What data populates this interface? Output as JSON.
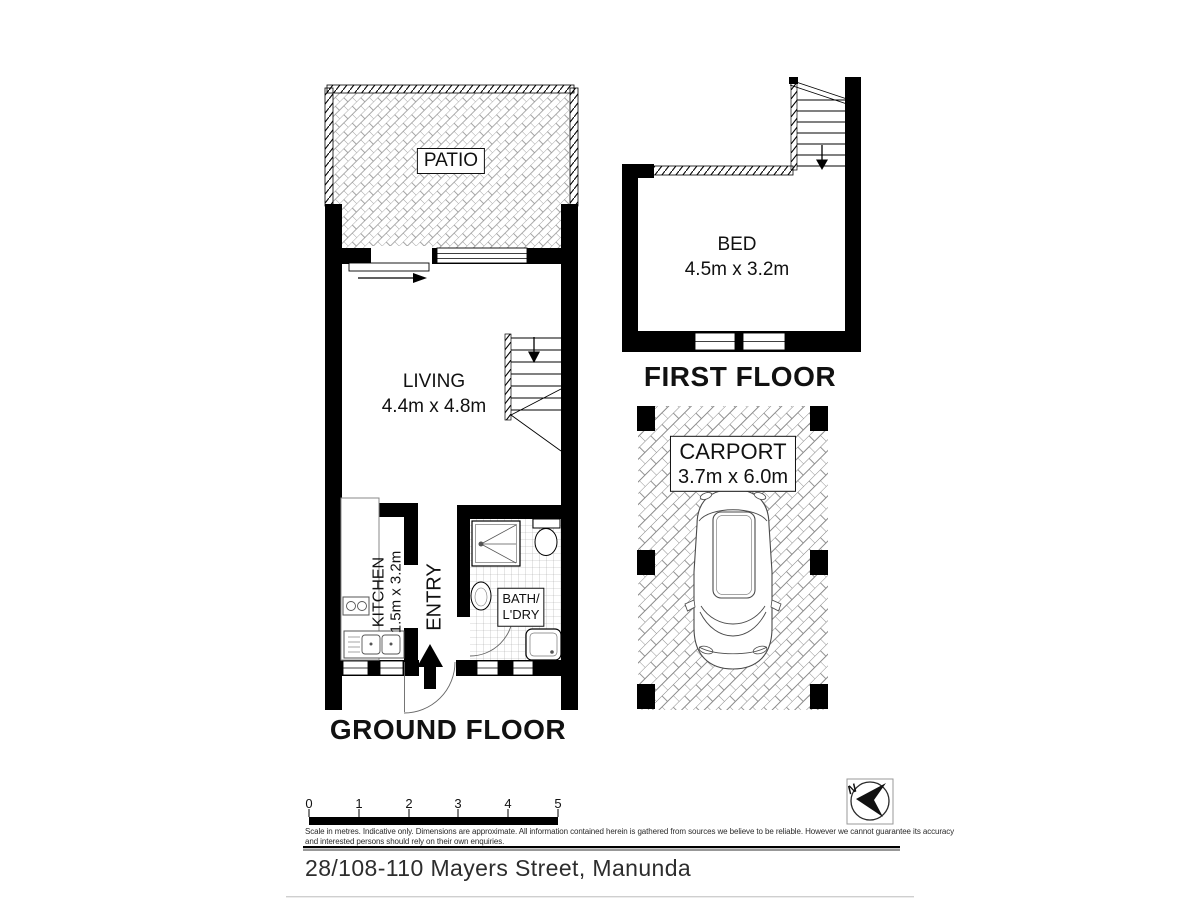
{
  "ground_floor": {
    "title": "GROUND FLOOR",
    "patio_label": "PATIO",
    "living_name": "LIVING",
    "living_dims": "4.4m x 4.8m",
    "kitchen_name": "KITCHEN",
    "kitchen_dims": "1.5m x 3.2m",
    "entry_label": "ENTRY",
    "bath_line1": "BATH/",
    "bath_line2": "L'DRY"
  },
  "first_floor": {
    "title": "FIRST FLOOR",
    "bed_name": "BED",
    "bed_dims": "4.5m x 3.2m"
  },
  "carport": {
    "name": "CARPORT",
    "dims": "3.7m x 6.0m"
  },
  "scale_bar": {
    "ticks": [
      "0",
      "1",
      "2",
      "3",
      "4",
      "5"
    ],
    "disclaimer_line1": "Scale in metres. Indicative only. Dimensions are approximate. All information contained herein is gathered from sources we believe to be reliable. However we cannot guarantee its accuracy",
    "disclaimer_line2": "and interested persons should rely on their own enquiries."
  },
  "compass": {
    "north_letter": "N"
  },
  "footer": {
    "address": "28/108-110 Mayers Street, Manunda"
  },
  "colors": {
    "walls": "#000000",
    "hatch_lines": "#8f8f8f",
    "tile_lines": "#a9a9a9",
    "text": "#111111",
    "address_text": "#2d2d2d",
    "faint_rule": "#cfcfcf"
  }
}
